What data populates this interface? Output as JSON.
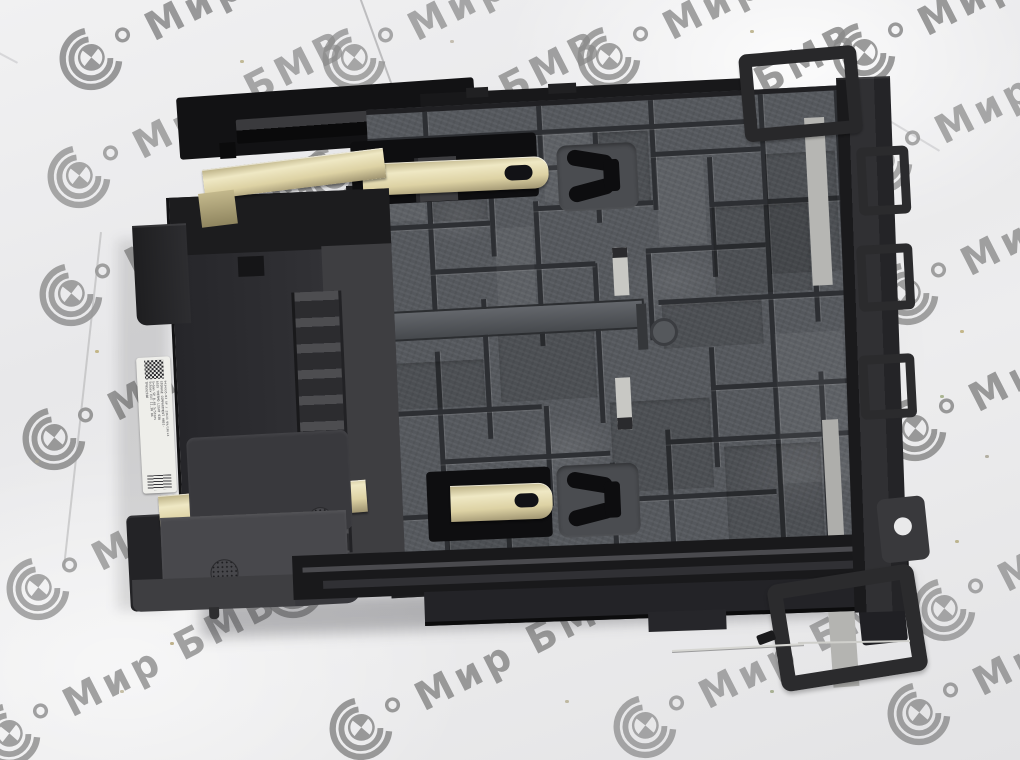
{
  "scene": {
    "description": "BMW storage compartment assembly (rear/bottom view) lying on crumpled white paper",
    "background": "white crumpled paper with repeating diagonal watermarks"
  },
  "watermark": {
    "text": "Мир БМВ",
    "color": "#8a8a8a",
    "logo": "bmw-roundel-arcs-icon"
  },
  "label": {
    "type": "white part sticker with datamatrix code and barcode, rotated 90°",
    "lines": [
      "9434935-03 SP / 23633 09/10/23",
      "STORAGE COMPARTMENT H051-",
      "ASSY THERMO LIGHT 030",
      "S=5mm SP 0.48 S/Stoev",
      "Schaev EXT 11.30 06",
      "TP0592108"
    ]
  },
  "colors": {
    "paper": "#ebebec",
    "watermark_gray": "#8a8a8a",
    "plastic_dark": "#1a1a1c",
    "plastic_mid": "#56595e",
    "gold_spring": "#d8cda0",
    "metal_silver": "#b6b6b3"
  }
}
